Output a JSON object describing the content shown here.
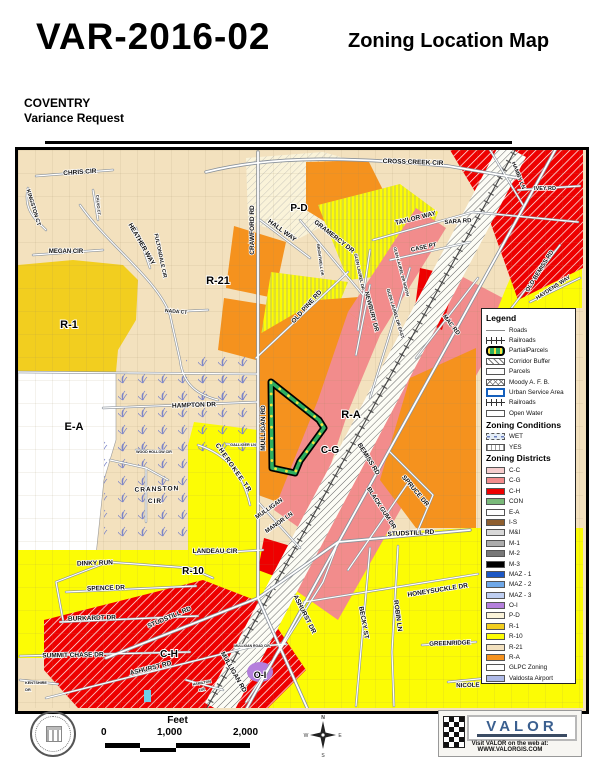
{
  "header": {
    "case_number": "VAR-2016-02",
    "map_type": "Zoning Location Map",
    "project_name": "COVENTRY",
    "request_type": "Variance Request"
  },
  "legend": {
    "title": "Legend",
    "items": [
      {
        "label": "Roads",
        "swatch": "road"
      },
      {
        "label": "Railroads",
        "swatch": "railroad"
      },
      {
        "label": "PartialParcels",
        "swatch": "partial"
      },
      {
        "label": "Corridor Buffer",
        "swatch": "corridor"
      },
      {
        "label": "Parcels",
        "swatch": "parcels"
      },
      {
        "label": "Moody A. F. B.",
        "swatch": "moody"
      },
      {
        "label": "Urban Service Area",
        "swatch": "usa"
      },
      {
        "label": "Railroads",
        "swatch": "railroad"
      },
      {
        "label": "Open Water",
        "swatch": "water"
      }
    ],
    "conditions_title": "Zoning Conditions",
    "conditions": [
      {
        "label": "WET",
        "swatch": "wet"
      },
      {
        "label": "YES",
        "swatch": "yes"
      }
    ],
    "districts_title": "Zoning Districts",
    "districts": [
      {
        "label": "C-C",
        "color": "#F6CDCD"
      },
      {
        "label": "C-G",
        "color": "#F28C8C"
      },
      {
        "label": "C-H",
        "color": "#EE0000"
      },
      {
        "label": "CON",
        "color": "#79B979"
      },
      {
        "label": "E-A",
        "color": "#FFFFFF"
      },
      {
        "label": "I-S",
        "color": "#8E5E2E"
      },
      {
        "label": "M&I",
        "color": "#D8D8D8"
      },
      {
        "label": "M-1",
        "color": "#ACACAC"
      },
      {
        "label": "M-2",
        "color": "#787878"
      },
      {
        "label": "M-3",
        "color": "#000000"
      },
      {
        "label": "MAZ - 1",
        "color": "#1C57C4"
      },
      {
        "label": "MAZ - 2",
        "color": "#6FA8E8"
      },
      {
        "label": "MAZ - 3",
        "color": "#BFCFF2"
      },
      {
        "label": "O-I",
        "color": "#B47FDC"
      },
      {
        "label": "P-D",
        "color": "#FAF3D9",
        "pattern": "diag"
      },
      {
        "label": "R-1",
        "color": "#F2CE1F"
      },
      {
        "label": "R-10",
        "color": "#FCFC05"
      },
      {
        "label": "R-21",
        "color": "#F3E1BE"
      },
      {
        "label": "R-A",
        "color": "#F5921E"
      },
      {
        "label": "GLPC Zoning",
        "color": "#FFFFFF",
        "pattern": "cyan-diag"
      },
      {
        "label": "Valdosta Airport",
        "color": "#AFBAE8"
      }
    ]
  },
  "map": {
    "road_labels": [
      {
        "t": "CHRIS CIR",
        "x": 62,
        "y": 24,
        "r": -4,
        "s": 6.5
      },
      {
        "t": "KINGSTON CT",
        "x": 14,
        "y": 58,
        "r": 73,
        "s": 5.5
      },
      {
        "t": "MEGAN CIR",
        "x": 48,
        "y": 103,
        "r": 0,
        "s": 6
      },
      {
        "t": "HEATHER WAY",
        "x": 122,
        "y": 95,
        "r": 60,
        "s": 6.5
      },
      {
        "t": "FULTONDALE CIR",
        "x": 141,
        "y": 106,
        "r": 78,
        "s": 5.2
      },
      {
        "t": "NADA CT",
        "x": 158,
        "y": 163,
        "r": 5,
        "s": 5
      },
      {
        "t": "CALVO CT",
        "x": 79,
        "y": 55,
        "r": 85,
        "s": 4
      },
      {
        "t": "CROSS CREEK CIR",
        "x": 395,
        "y": 14,
        "r": 2,
        "s": 6.5
      },
      {
        "t": "CRAWFORD RD",
        "x": 236,
        "y": 80,
        "r": -90,
        "s": 6.5
      },
      {
        "t": "HALL WAY",
        "x": 263,
        "y": 82,
        "r": 36,
        "s": 6.5
      },
      {
        "t": "GRAMERCY DR",
        "x": 315,
        "y": 88,
        "r": 38,
        "s": 6.5
      },
      {
        "t": "TAYLOR WAY",
        "x": 398,
        "y": 70,
        "r": -14,
        "s": 6.5
      },
      {
        "t": "SARA RD",
        "x": 440,
        "y": 73,
        "r": -4,
        "s": 6
      },
      {
        "t": "CASE PT",
        "x": 406,
        "y": 99,
        "r": -12,
        "s": 6
      },
      {
        "t": "GLEN LAUREL DR",
        "x": 340,
        "y": 122,
        "r": 78,
        "s": 4.2
      },
      {
        "t": "GLEN LAUREL DR NORTH",
        "x": 382,
        "y": 122,
        "r": 75,
        "s": 4
      },
      {
        "t": "BRIGHTWELL DR",
        "x": 301,
        "y": 110,
        "r": 82,
        "s": 3.8
      },
      {
        "t": "OLD PINE RD",
        "x": 290,
        "y": 158,
        "r": -48,
        "s": 6.5
      },
      {
        "t": "NEWBURY DR",
        "x": 352,
        "y": 162,
        "r": 75,
        "s": 6
      },
      {
        "t": "GLEN LAUREL DR EAST",
        "x": 376,
        "y": 164,
        "r": 73,
        "s": 4.4
      },
      {
        "t": "MAC RD",
        "x": 432,
        "y": 176,
        "r": 52,
        "s": 6
      },
      {
        "t": "HAMBY LN",
        "x": 499,
        "y": 26,
        "r": 68,
        "s": 5.5
      },
      {
        "t": "IVEY RD",
        "x": 527,
        "y": 40,
        "r": 0,
        "s": 5.5
      },
      {
        "t": "OLD BEMISS RD",
        "x": 523,
        "y": 122,
        "r": -58,
        "s": 6
      },
      {
        "t": "HAYDENS WAY",
        "x": 536,
        "y": 139,
        "r": -33,
        "s": 5.5
      },
      {
        "t": "HAMPTON DR",
        "x": 176,
        "y": 257,
        "r": -2,
        "s": 6.5
      },
      {
        "t": "WOOD HOLLOW CIR",
        "x": 136,
        "y": 303,
        "r": 0,
        "s": 3.6
      },
      {
        "t": "CRANSTON",
        "x": 139,
        "y": 341,
        "r": -2,
        "s": 6.5,
        "ls": 1
      },
      {
        "t": "CIR",
        "x": 137,
        "y": 353,
        "r": 0,
        "s": 6.5,
        "ls": 1
      },
      {
        "t": "GALLIGER LN",
        "x": 225,
        "y": 296,
        "r": 0,
        "s": 3.8
      },
      {
        "t": "CHEROKEE TR",
        "x": 214,
        "y": 319,
        "r": 55,
        "s": 6.5,
        "ls": 1
      },
      {
        "t": "MULLIGAN RD",
        "x": 247,
        "y": 278,
        "r": -90,
        "s": 6.5
      },
      {
        "t": "MULLIGAN",
        "x": 252,
        "y": 360,
        "r": -35,
        "s": 6
      },
      {
        "t": "MANOR LN",
        "x": 262,
        "y": 374,
        "r": -35,
        "s": 6
      },
      {
        "t": "LANDEAU CIR",
        "x": 197,
        "y": 403,
        "r": 0,
        "s": 6.5
      },
      {
        "t": "DINKY RUN",
        "x": 77,
        "y": 415,
        "r": -2,
        "s": 6.5
      },
      {
        "t": "SPENCE DR",
        "x": 88,
        "y": 440,
        "r": -2,
        "s": 6.5
      },
      {
        "t": "BURKARDT DR",
        "x": 74,
        "y": 470,
        "r": -2,
        "s": 6.5
      },
      {
        "t": "SUMMIT CHASE DR",
        "x": 55,
        "y": 507,
        "r": -1,
        "s": 6.5
      },
      {
        "t": "KENTSHIRE",
        "x": 18,
        "y": 534,
        "r": 0,
        "s": 3.8
      },
      {
        "t": "DR",
        "x": 10,
        "y": 541,
        "r": 0,
        "s": 3.8
      },
      {
        "t": "STUDSTILL RD",
        "x": 152,
        "y": 469,
        "r": -23,
        "s": 6.5
      },
      {
        "t": "ASHURST RD",
        "x": 133,
        "y": 520,
        "r": -14,
        "s": 6.5
      },
      {
        "t": "MULLIGAN RD",
        "x": 214,
        "y": 523,
        "r": 60,
        "s": 6.5
      },
      {
        "t": "MULLIGAN ROAD CIR",
        "x": 234,
        "y": 497,
        "r": 0,
        "s": 3.4
      },
      {
        "t": "HAMILTON",
        "x": 184,
        "y": 534,
        "r": -10,
        "s": 3.6
      },
      {
        "t": "CIR",
        "x": 184,
        "y": 541,
        "r": -10,
        "s": 3.6
      },
      {
        "t": "ASHURST DR",
        "x": 285,
        "y": 465,
        "r": 63,
        "s": 6.5
      },
      {
        "t": "BECKY ST",
        "x": 344,
        "y": 473,
        "r": 80,
        "s": 6.5
      },
      {
        "t": "ROBIN LN",
        "x": 378,
        "y": 466,
        "r": 82,
        "s": 6.5
      },
      {
        "t": "HONEYSUCKLE DR",
        "x": 420,
        "y": 442,
        "r": -9,
        "s": 6.5
      },
      {
        "t": "GREENRIDGE",
        "x": 432,
        "y": 495,
        "r": -2,
        "s": 6.2
      },
      {
        "t": "NICOLE",
        "x": 450,
        "y": 537,
        "r": -2,
        "s": 6.2
      },
      {
        "t": "STUDSTILL RD",
        "x": 393,
        "y": 385,
        "r": -3,
        "s": 6.5
      },
      {
        "t": "SPRUCE DR",
        "x": 396,
        "y": 342,
        "r": 50,
        "s": 6.5
      },
      {
        "t": "BLACK GUM DR",
        "x": 362,
        "y": 359,
        "r": 57,
        "s": 6.2
      },
      {
        "t": "BEMISS RD",
        "x": 349,
        "y": 310,
        "r": 58,
        "s": 6.5
      }
    ],
    "zone_labels": [
      {
        "t": "R-1",
        "x": 51,
        "y": 178,
        "s": 11
      },
      {
        "t": "R-21",
        "x": 200,
        "y": 134,
        "s": 11
      },
      {
        "t": "E-A",
        "x": 56,
        "y": 280,
        "s": 11
      },
      {
        "t": "P-D",
        "x": 281,
        "y": 61,
        "s": 10
      },
      {
        "t": "R-A",
        "x": 333,
        "y": 268,
        "s": 11
      },
      {
        "t": "C-G",
        "x": 312,
        "y": 303,
        "s": 10
      },
      {
        "t": "R-10",
        "x": 175,
        "y": 424,
        "s": 10
      },
      {
        "t": "C-H",
        "x": 151,
        "y": 507,
        "s": 10
      },
      {
        "t": "O-I",
        "x": 242,
        "y": 528,
        "s": 9,
        "fill": "#ffffff"
      }
    ]
  },
  "footer": {
    "feet_label": "Feet",
    "scale_ticks": [
      "0",
      "1,000",
      "2,000"
    ],
    "compass_points": [
      "N",
      "E",
      "S",
      "W"
    ],
    "valor": {
      "name": "VALOR",
      "web_line": "Visit VALOR on the web at: WWW.VALORGIS.COM"
    }
  }
}
